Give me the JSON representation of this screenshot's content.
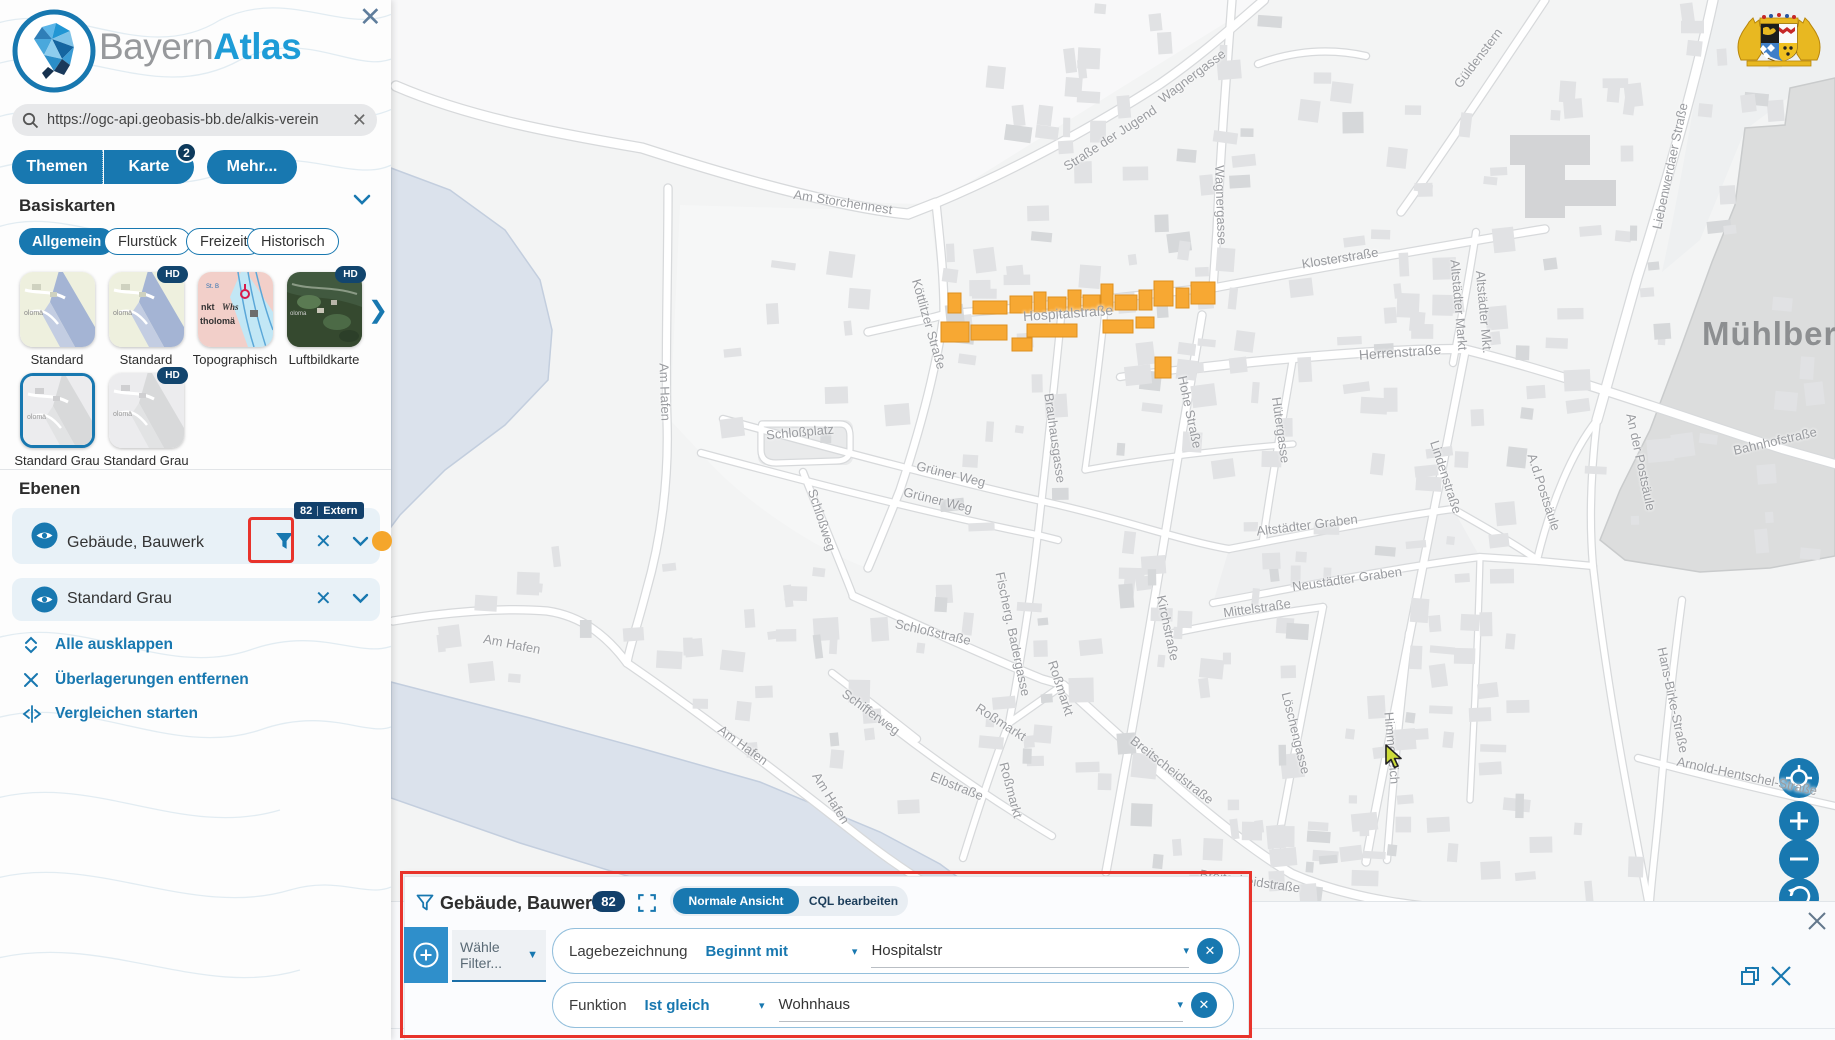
{
  "sidebar": {
    "close_label": "✕",
    "logo": {
      "bayern": "Bayern",
      "atlas": "Atlas"
    },
    "search": {
      "value": "https://ogc-api.geobasis-bb.de/alkis-verein",
      "close": "✕"
    },
    "tabs": {
      "themen": "Themen",
      "karte": "Karte",
      "karte_badge": "2",
      "mehr": "Mehr..."
    },
    "basiskarten": {
      "title": "Basiskarten",
      "categories": [
        "Allgemein",
        "Flurstück",
        "Freizeit",
        "Historisch"
      ],
      "selected_category": "Allgemein",
      "hd_label": "HD",
      "thumbnails": [
        {
          "label": "Standard",
          "hd": false,
          "selected": false
        },
        {
          "label": "Standard",
          "hd": true,
          "selected": false
        },
        {
          "label": "Topographisch",
          "hd": false,
          "selected": false
        },
        {
          "label": "Luftbildkarte",
          "hd": true,
          "selected": false
        },
        {
          "label": "Standard Grau",
          "hd": false,
          "selected": true
        },
        {
          "label": "Standard Grau",
          "hd": true,
          "selected": false
        }
      ]
    },
    "ebenen": {
      "title": "Ebenen",
      "layers": [
        {
          "name": "Gebäude, Bauwerk",
          "badge_count": "82",
          "badge_label": "Extern"
        },
        {
          "name": "Standard Grau"
        }
      ],
      "actions": [
        {
          "label": "Alle ausklappen"
        },
        {
          "label": "Überlagerungen entfernen"
        },
        {
          "label": "Vergleichen starten"
        }
      ]
    }
  },
  "map": {
    "place_label": "Mühlberg",
    "street_labels": [
      [
        "Wagnergasse",
        1192,
        76,
        -37
      ],
      [
        "Wagnergasse",
        1221,
        205,
        88
      ],
      [
        "Straße der Jugend",
        1110,
        138,
        -33
      ],
      [
        "Am Storchennest",
        843,
        202,
        9
      ],
      [
        "Köttlitzer Straße",
        929,
        324,
        74
      ],
      [
        "Hospitalstraße",
        1068,
        313,
        -4,
        14
      ],
      [
        "Klosterstraße",
        1340,
        258,
        -9
      ],
      [
        "Güldenstern",
        1478,
        58,
        -53
      ],
      [
        "Liebenwerdaer Straße",
        1670,
        166,
        -78
      ],
      [
        "Altstädter Markt",
        1459,
        305,
        85
      ],
      [
        "Altstädter Mkt.",
        1484,
        312,
        85
      ],
      [
        "Herrenstraße",
        1400,
        352,
        -4,
        14
      ],
      [
        "Hohe Straße",
        1190,
        412,
        78
      ],
      [
        "Hütergasse",
        1281,
        430,
        82
      ],
      [
        "Lindenstraße",
        1446,
        477,
        72
      ],
      [
        "Bahnhofstraße",
        1775,
        441,
        -13
      ],
      [
        "An der Postsäule",
        1641,
        462,
        78
      ],
      [
        "A.d.Postsäule",
        1544,
        492,
        72
      ],
      [
        "Altstädter Graben",
        1307,
        525,
        -7
      ],
      [
        "Neustädter Graben",
        1347,
        579,
        -8
      ],
      [
        "Mittelstraße",
        1257,
        608,
        -8
      ],
      [
        "Kirchstraße",
        1168,
        628,
        78
      ],
      [
        "Löschengasse",
        1296,
        733,
        76
      ],
      [
        "Himmelreich",
        1392,
        748,
        85
      ],
      [
        "Breitscheidstraße",
        1172,
        770,
        38
      ],
      [
        "Breitscheidstraße",
        1250,
        881,
        8
      ],
      [
        "Schloßplatz",
        800,
        432,
        -5
      ],
      [
        "Schloßweg",
        822,
        520,
        72
      ],
      [
        "Schloßstraße",
        933,
        632,
        13
      ],
      [
        "Grüner Weg",
        951,
        474,
        14
      ],
      [
        "Grüner Weg",
        938,
        500,
        14
      ],
      [
        "Brauhausgasse",
        1055,
        438,
        82
      ],
      [
        "Fischerg. Badergasse",
        1013,
        634,
        78
      ],
      [
        "Roßmarkt",
        1001,
        722,
        33
      ],
      [
        "Roßmarkt",
        1061,
        688,
        72
      ],
      [
        "Roßmarkt",
        1011,
        790,
        75
      ],
      [
        "Elbstraße",
        957,
        786,
        22
      ],
      [
        "Schifferweg",
        871,
        712,
        36
      ],
      [
        "Am Hafen",
        665,
        392,
        88
      ],
      [
        "Am Hafen",
        512,
        644,
        11
      ],
      [
        "Am Hafen",
        743,
        745,
        36
      ],
      [
        "Am Hafen",
        831,
        798,
        58
      ],
      [
        "Arnold-Hentschel-Straße",
        1747,
        776,
        12
      ],
      [
        "Hans-Birke-Straße",
        1673,
        700,
        78
      ]
    ],
    "highlighted_buildings": [
      [
        948,
        293,
        13,
        20
      ],
      [
        973,
        301,
        34,
        13
      ],
      [
        1010,
        296,
        22,
        17
      ],
      [
        1034,
        292,
        12,
        20
      ],
      [
        1048,
        297,
        18,
        14
      ],
      [
        1068,
        290,
        13,
        21
      ],
      [
        1083,
        295,
        17,
        15
      ],
      [
        1101,
        284,
        12,
        27
      ],
      [
        1115,
        295,
        22,
        15
      ],
      [
        1139,
        290,
        13,
        20
      ],
      [
        1154,
        281,
        19,
        25
      ],
      [
        1176,
        288,
        13,
        20
      ],
      [
        1191,
        282,
        24,
        22
      ],
      [
        941,
        322,
        28,
        20
      ],
      [
        971,
        325,
        36,
        15
      ],
      [
        1012,
        338,
        20,
        13
      ],
      [
        1027,
        324,
        50,
        13
      ],
      [
        1103,
        320,
        30,
        13
      ],
      [
        1136,
        317,
        18,
        11
      ],
      [
        1155,
        357,
        16,
        21
      ]
    ],
    "highlight_color": "#f7a833",
    "highlight_stroke": "#dd8f1f"
  },
  "filter_panel": {
    "title": "Gebäude, Bauwerk",
    "count": "82",
    "toggle": {
      "normal": "Normale Ansicht",
      "cql": "CQL bearbeiten"
    },
    "select_placeholder": "Wähle Filter...",
    "rows": [
      {
        "field": "Lagebezeichnung",
        "operator": "Beginnt mit",
        "value": "Hospitalstr"
      },
      {
        "field": "Funktion",
        "operator": "Ist gleich",
        "value": "Wohnhaus"
      }
    ],
    "close": "✕"
  },
  "colors": {
    "accent": "#1878b0",
    "badge": "#12406b",
    "annotation": "#e8332b",
    "water": "#dbe2ec"
  }
}
